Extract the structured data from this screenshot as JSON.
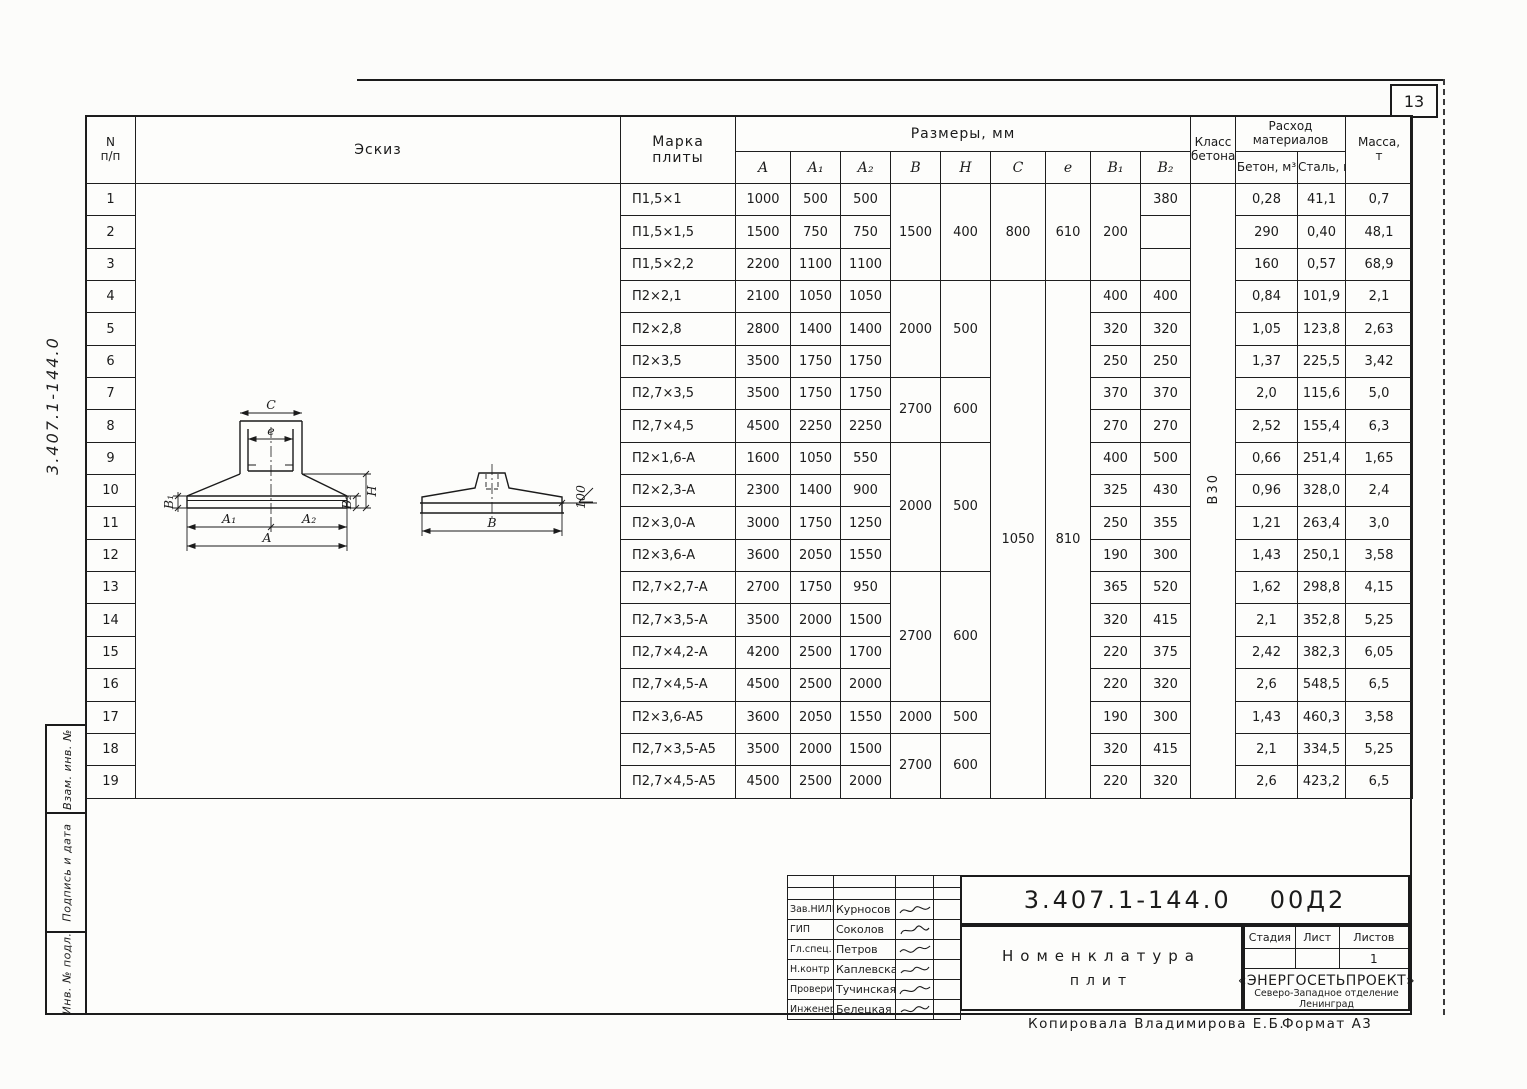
{
  "page": {
    "number": "13",
    "copied_line": "Копировала  Владимирова Е.Б.",
    "format_label": "Формат А3"
  },
  "left_stamp": {
    "doc_number_vertical": "3.407.1-144.0",
    "boxes": [
      "Взам. инв. №",
      "Подпись и дата",
      "Инв. № подл."
    ]
  },
  "sketch": {
    "c": "C",
    "e": "e",
    "b1": "В₁",
    "b2": "В₂",
    "h": "H",
    "a1": "А₁",
    "a2": "А₂",
    "a": "А",
    "b": "В",
    "elev": "100"
  },
  "table": {
    "col_no": "N",
    "col_no2": "п/п",
    "col_sketch": "Эскиз",
    "col_mark_1": "Марка",
    "col_mark_2": "плиты",
    "col_sizes": "Размеры, мм",
    "size_cols": [
      "А",
      "А₁",
      "А₂",
      "В",
      "Н",
      "С",
      "е",
      "В₁",
      "В₂"
    ],
    "col_class_1": "Класс",
    "col_class_2": "бетона",
    "col_materials_1": "Расход",
    "col_materials_2": "материалов",
    "col_concrete": "Бетон, м³",
    "col_steel": "Сталь, кг",
    "col_mass_1": "Масса,",
    "col_mass_2": "т",
    "concrete_class": "В30",
    "rows": [
      {
        "n": "1",
        "mark": "П1,5×1",
        "a": "1000",
        "a1": "500",
        "a2": "500",
        "b": "1500",
        "h": "400",
        "bh_span": 3,
        "c": "800",
        "e": "610",
        "ce_span": 3,
        "b1": "200",
        "b1_span": 3,
        "b2": "380",
        "concrete": "0,28",
        "steel": "41,1",
        "mass": "0,7"
      },
      {
        "n": "2",
        "mark": "П1,5×1,5",
        "a": "1500",
        "a1": "750",
        "a2": "750",
        "b2": "290",
        "concrete": "0,40",
        "steel": "48,1",
        "mass": "1,0"
      },
      {
        "n": "3",
        "mark": "П1,5×2,2",
        "a": "2200",
        "a1": "1100",
        "a2": "1100",
        "b2": "160",
        "concrete": "0,57",
        "steel": "68,9",
        "mass": "1,43"
      },
      {
        "n": "4",
        "mark": "П2×2,1",
        "a": "2100",
        "a1": "1050",
        "a2": "1050",
        "b": "2000",
        "h": "500",
        "bh_span": 3,
        "c": "1050",
        "e": "810",
        "ce_span": 16,
        "b1": "400",
        "b2": "400",
        "concrete": "0,84",
        "steel": "101,9",
        "mass": "2,1"
      },
      {
        "n": "5",
        "mark": "П2×2,8",
        "a": "2800",
        "a1": "1400",
        "a2": "1400",
        "b1": "320",
        "b2": "320",
        "concrete": "1,05",
        "steel": "123,8",
        "mass": "2,63"
      },
      {
        "n": "6",
        "mark": "П2×3,5",
        "a": "3500",
        "a1": "1750",
        "a2": "1750",
        "b1": "250",
        "b2": "250",
        "concrete": "1,37",
        "steel": "225,5",
        "mass": "3,42"
      },
      {
        "n": "7",
        "mark": "П2,7×3,5",
        "a": "3500",
        "a1": "1750",
        "a2": "1750",
        "b": "2700",
        "h": "600",
        "bh_span": 2,
        "b1": "370",
        "b2": "370",
        "concrete": "2,0",
        "steel": "115,6",
        "mass": "5,0"
      },
      {
        "n": "8",
        "mark": "П2,7×4,5",
        "a": "4500",
        "a1": "2250",
        "a2": "2250",
        "b1": "270",
        "b2": "270",
        "concrete": "2,52",
        "steel": "155,4",
        "mass": "6,3"
      },
      {
        "n": "9",
        "mark": "П2×1,6-А",
        "a": "1600",
        "a1": "1050",
        "a2": "550",
        "b": "2000",
        "h": "500",
        "bh_span": 4,
        "b1": "400",
        "b2": "500",
        "concrete": "0,66",
        "steel": "251,4",
        "mass": "1,65"
      },
      {
        "n": "10",
        "mark": "П2×2,3-А",
        "a": "2300",
        "a1": "1400",
        "a2": "900",
        "b1": "325",
        "b2": "430",
        "concrete": "0,96",
        "steel": "328,0",
        "mass": "2,4"
      },
      {
        "n": "11",
        "mark": "П2×3,0-А",
        "a": "3000",
        "a1": "1750",
        "a2": "1250",
        "b1": "250",
        "b2": "355",
        "concrete": "1,21",
        "steel": "263,4",
        "mass": "3,0"
      },
      {
        "n": "12",
        "mark": "П2×3,6-А",
        "a": "3600",
        "a1": "2050",
        "a2": "1550",
        "b1": "190",
        "b2": "300",
        "concrete": "1,43",
        "steel": "250,1",
        "mass": "3,58"
      },
      {
        "n": "13",
        "mark": "П2,7×2,7-А",
        "a": "2700",
        "a1": "1750",
        "a2": "950",
        "b": "2700",
        "h": "600",
        "bh_span": 4,
        "b1": "365",
        "b2": "520",
        "concrete": "1,62",
        "steel": "298,8",
        "mass": "4,15"
      },
      {
        "n": "14",
        "mark": "П2,7×3,5-А",
        "a": "3500",
        "a1": "2000",
        "a2": "1500",
        "b1": "320",
        "b2": "415",
        "concrete": "2,1",
        "steel": "352,8",
        "mass": "5,25"
      },
      {
        "n": "15",
        "mark": "П2,7×4,2-А",
        "a": "4200",
        "a1": "2500",
        "a2": "1700",
        "b1": "220",
        "b2": "375",
        "concrete": "2,42",
        "steel": "382,3",
        "mass": "6,05"
      },
      {
        "n": "16",
        "mark": "П2,7×4,5-А",
        "a": "4500",
        "a1": "2500",
        "a2": "2000",
        "b1": "220",
        "b2": "320",
        "concrete": "2,6",
        "steel": "548,5",
        "mass": "6,5"
      },
      {
        "n": "17",
        "mark": "П2×3,6-А5",
        "a": "3600",
        "a1": "2050",
        "a2": "1550",
        "b": "2000",
        "h": "500",
        "bh_span": 1,
        "b1": "190",
        "b2": "300",
        "concrete": "1,43",
        "steel": "460,3",
        "mass": "3,58"
      },
      {
        "n": "18",
        "mark": "П2,7×3,5-А5",
        "a": "3500",
        "a1": "2000",
        "a2": "1500",
        "b": "2700",
        "h": "600",
        "bh_span": 2,
        "b1": "320",
        "b2": "415",
        "concrete": "2,1",
        "steel": "334,5",
        "mass": "5,25"
      },
      {
        "n": "19",
        "mark": "П2,7×4,5-А5",
        "a": "4500",
        "a1": "2500",
        "a2": "2000",
        "b1": "220",
        "b2": "320",
        "concrete": "2,6",
        "steel": "423,2",
        "mass": "6,5"
      }
    ]
  },
  "title_block": {
    "doc_number": "3.407.1-144.0",
    "doc_suffix": "00Д2",
    "title_1": "Номенклатура",
    "title_2": "плит",
    "stage_label": "Стадия",
    "sheet_label": "Лист",
    "sheets_label": "Листов",
    "stage_value": "",
    "sheet_value": "",
    "sheets_value": "1",
    "org_1": "«ЭНЕРГОСЕТЬПРОЕКТ»",
    "org_2": "Северо-Западное отделение",
    "org_3": "Ленинград",
    "signatures": [
      {
        "role": "Зав.НИЛКЭ",
        "name": "Курносов"
      },
      {
        "role": "ГИП",
        "name": "Соколов"
      },
      {
        "role": "Гл.спец.",
        "name": "Петров"
      },
      {
        "role": "Н.контр",
        "name": "Каплевская"
      },
      {
        "role": "Проверила",
        "name": "Тучинская"
      },
      {
        "role": "Инженер",
        "name": "Белецкая"
      }
    ]
  }
}
